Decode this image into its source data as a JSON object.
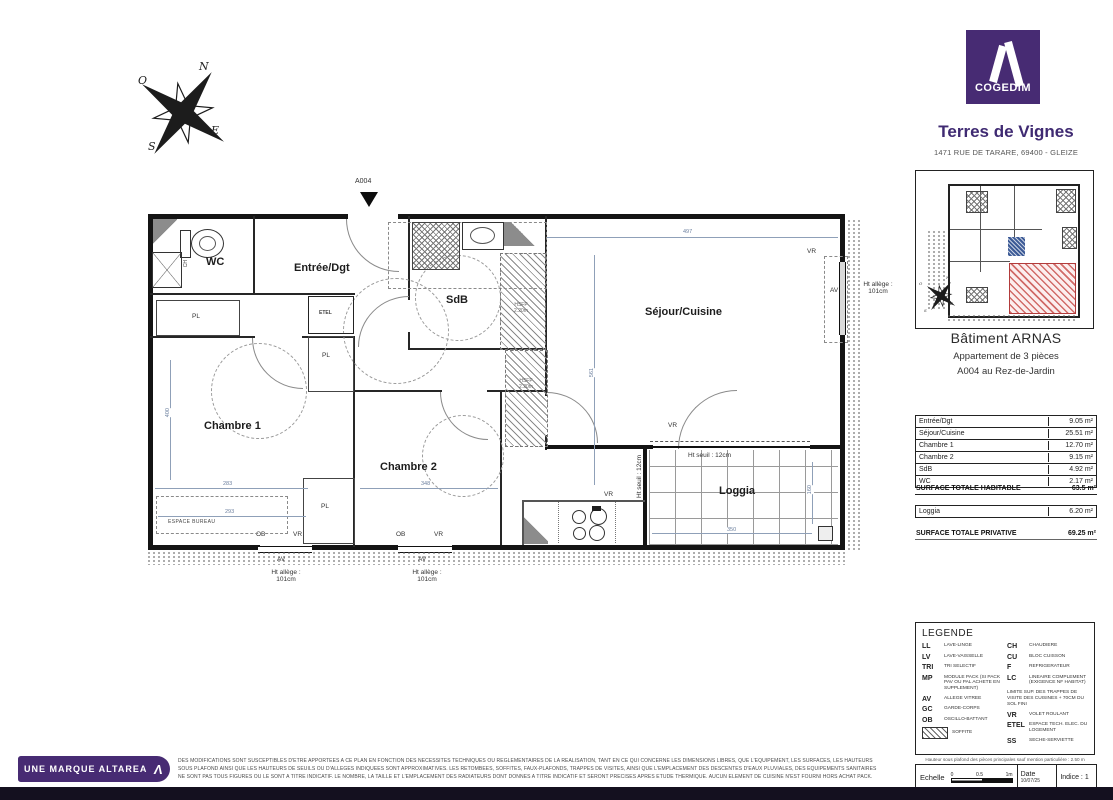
{
  "compass": {
    "n": "N",
    "e": "E",
    "s": "S",
    "o": "O"
  },
  "plan": {
    "entrance_tag": "A004",
    "rooms": {
      "wc": "WC",
      "entree": "Entrée/Dgt",
      "sdb": "SdB",
      "sejour": "Séjour/Cuisine",
      "chambre1": "Chambre 1",
      "chambre2": "Chambre 2",
      "loggia": "Loggia"
    },
    "labels": {
      "pl": "PL",
      "etel": "ETEL",
      "ch": "CH",
      "hsfp_line1": "HSFP",
      "hsfp_line2": "2.20m",
      "espace_bureau": "ESPACE BUREAU",
      "ob": "OB",
      "vr": "VR",
      "av": "AV",
      "ht_allege_1": "Ht allège :",
      "ht_allege_2": "101cm",
      "ht_seuil": "Ht seuil : 12cm"
    },
    "dims": {
      "top": "497",
      "c1_w": "283",
      "c1_w2": "293",
      "c1_h": "400",
      "c2_w": "348",
      "sejour_h": "561",
      "loggia_w": "350",
      "loggia_h": "160"
    }
  },
  "sidebar": {
    "brand": "COGEDIM",
    "program": "Terres de Vignes",
    "address": "1471 RUE DE TARARE, 69400 - GLEIZE",
    "building": "Bâtiment ARNAS",
    "apt_line1": "Appartement de 3 pièces",
    "apt_line2": "A004 au Rez-de-Jardin",
    "surfaces": {
      "rows": [
        {
          "label": "Entrée/Dgt",
          "value": "9.05 m²"
        },
        {
          "label": "Séjour/Cuisine",
          "value": "25.51 m²"
        },
        {
          "label": "Chambre 1",
          "value": "12.70 m²"
        },
        {
          "label": "Chambre 2",
          "value": "9.15 m²"
        },
        {
          "label": "SdB",
          "value": "4.92 m²"
        },
        {
          "label": "WC",
          "value": "2.17 m²"
        }
      ],
      "total_hab_label": "SURFACE TOTALE HABITABLE",
      "total_hab_value": "63.5 m²",
      "loggia_label": "Loggia",
      "loggia_value": "6.20 m²",
      "total_priv_label": "SURFACE TOTALE PRIVATIVE",
      "total_priv_value": "69.25 m²"
    },
    "legend": {
      "title": "LEGENDE",
      "left": [
        {
          "abbr": "LL",
          "desc": "LAVE-LINGE"
        },
        {
          "abbr": "LV",
          "desc": "LAVE-VAISSELLE"
        },
        {
          "abbr": "TRI",
          "desc": "TRI SELECTIF"
        },
        {
          "abbr": "MP",
          "desc": "MODULE PACK (SI PACK PAV OU PAL ACHETE EN SUPPLEMENT)"
        },
        {
          "abbr": "AV",
          "desc": "ALLEGE VITREE"
        },
        {
          "abbr": "GC",
          "desc": "GARDE-CORPS"
        },
        {
          "abbr": "OB",
          "desc": "OSCILLO-BATTANT"
        }
      ],
      "soffite": "SOFFITE",
      "right": [
        {
          "abbr": "CH",
          "desc": "CHAUDIERE"
        },
        {
          "abbr": "CU",
          "desc": "BLOC CUISSON"
        },
        {
          "abbr": "F",
          "desc": "REFRIGERATEUR"
        },
        {
          "abbr": "LC",
          "desc": "LINEAIRE COMPLEMENT (EXIGENCE NF HABITAT)"
        }
      ],
      "note": "LIMITE SUP. DES TRAPPES DE VISITE DES CUISINES + 70CM DU SOL FINI",
      "right2": [
        {
          "abbr": "VR",
          "desc": "VOLET ROULANT"
        },
        {
          "abbr": "ETEL",
          "desc": "ESPACE TECH. ELEC. DU LOGEMENT"
        },
        {
          "abbr": "SS",
          "desc": "SECHE-SERVIETTE"
        }
      ]
    },
    "ceiling_note": "Hauteur sous plafond des pièces principales sauf mention particulière : 2.50 m",
    "titleblock": {
      "scale_label": "Echelle",
      "tick0": "0",
      "tick1": "0.5",
      "tick2": "1m",
      "date_label": "Date",
      "date_value": "10/07/25",
      "indice": "Indice : 1"
    }
  },
  "footer": {
    "badge": "UNE MARQUE ALTAREA",
    "line1": "DES MODIFICATIONS SONT SUSCEPTIBLES D'ETRE APPORTEES A CE PLAN EN FONCTION DES NECESSITES TECHNIQUES OU REGLEMENTAIRES DE LA REALISATION, TANT EN CE QUI CONCERNE LES DIMENSIONS LIBRES, QUE L'EQUIPEMENT, LES SURFACES, LES HAUTEURS",
    "line2": "SOUS PLAFOND AINSI QUE LES HAUTEURS DE SEUILS OU D'ALLEGES INDIQUEES SONT APPROXIMATIVES. LES RETOMBEES, SOFFITES, FAUX-PLAFONDS, TRAPPES DE VISITES, AINSI QUE L'EMPLACEMENT DES DESCENTES D'EAUX PLUVIALES, DES EQUIPEMENTS SANITAIRES",
    "line3": "NE SONT PAS TOUS FIGURES OU LE SONT A TITRE INDICATIF. LE NOMBRE, LA TAILLE ET L'EMPLACEMENT DES RADIATEURS DONT DONNES A TITRE INDICATIF ET SERONT PRECISES APRES ETUDE THERMIQUE. AUCUN ELEMENT DE CUISINE N'EST FOURNI HORS ACHAT PACK."
  },
  "colors": {
    "brand_purple": "#472b73",
    "dim_blue": "#6b7f9e",
    "highlight_red": "#c9514e"
  }
}
